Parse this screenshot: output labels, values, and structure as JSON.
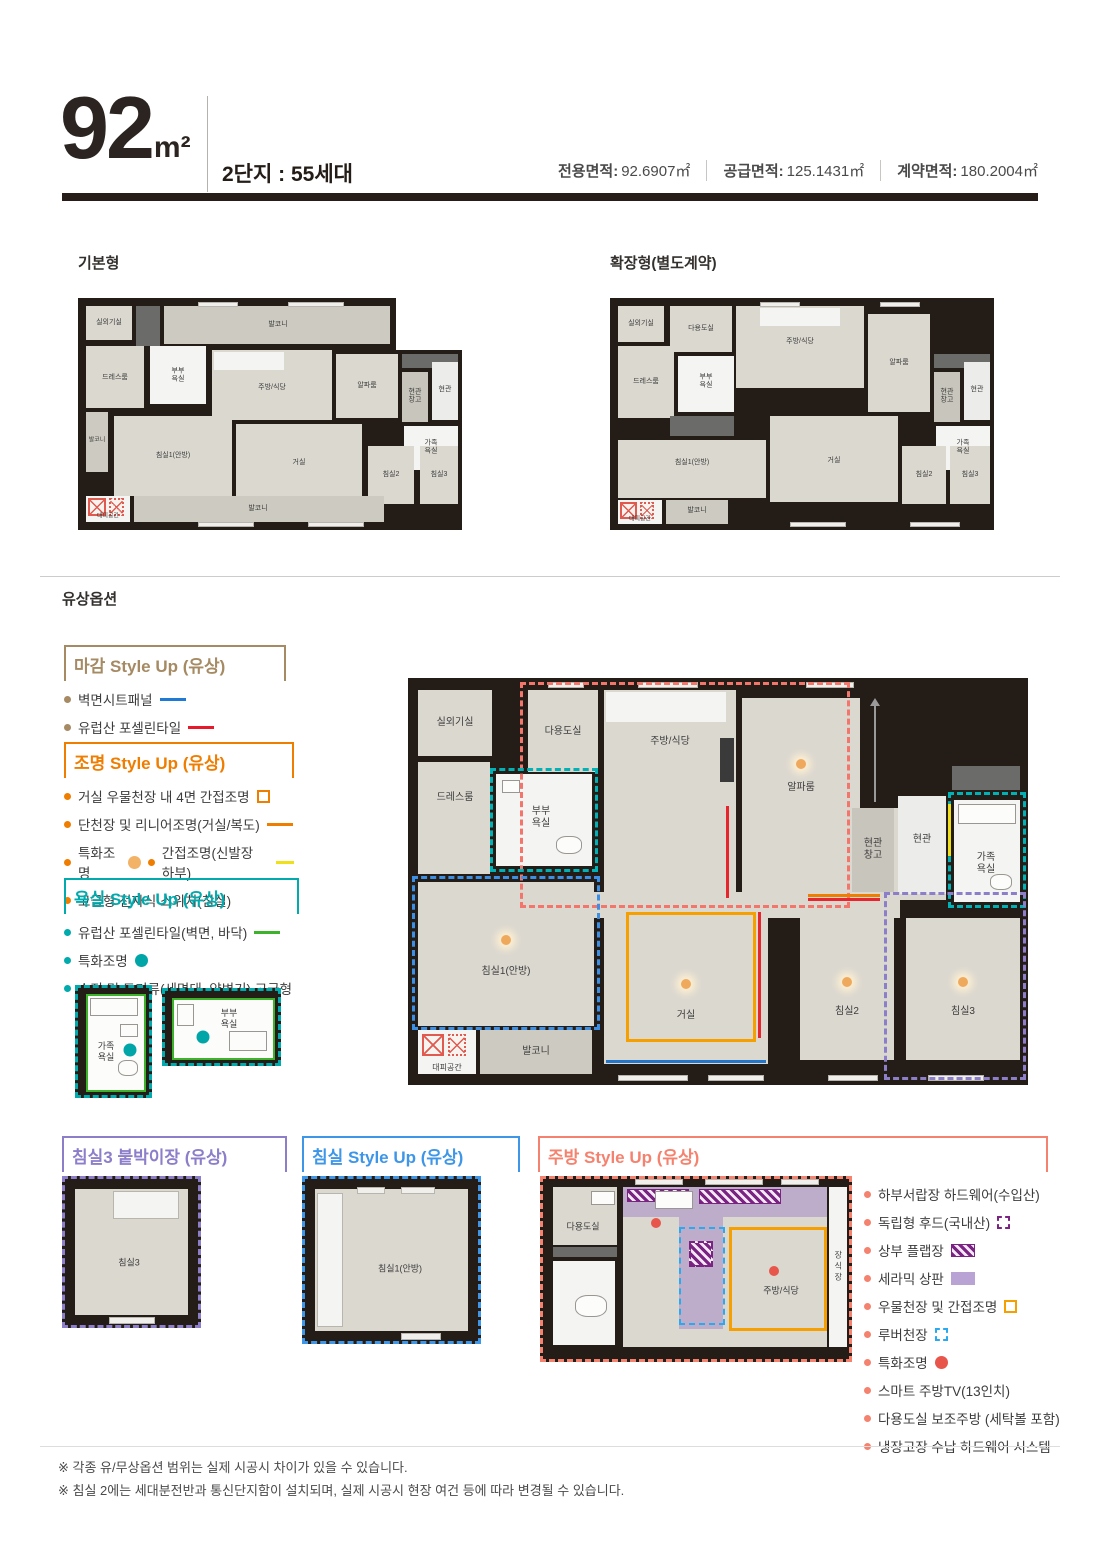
{
  "header": {
    "size": "92",
    "size_unit": "m²",
    "subtitle": "2단지 : 55세대",
    "metrics": [
      {
        "label": "전용면적:",
        "value": "92.6907㎡"
      },
      {
        "label": "공급면적:",
        "value": "125.1431㎡"
      },
      {
        "label": "계약면적:",
        "value": "180.2004㎡"
      }
    ]
  },
  "sections": {
    "basic": "기본형",
    "extended": "확장형(별도계약)",
    "paid": "유상옵션"
  },
  "rooms": {
    "outdoor": "실외기실",
    "utility": "다용도실",
    "dress": "드레스룸",
    "bath_couple": "부부 욕실",
    "kitchen": "주방/식당",
    "alpha": "알파룸",
    "storage": "현관 창고",
    "entrance": "현관",
    "bath_family": "가족 욕실",
    "balcony": "발코니",
    "bed1": "침실1(안방)",
    "living": "거실",
    "bed2": "침실2",
    "bed3": "침실3",
    "refuge": "대피공간",
    "closet": "장식장"
  },
  "legends": {
    "finish": {
      "title": "마감 Style Up (유상)",
      "items": [
        "벽면시트패널",
        "유럽산 포셀린타일"
      ]
    },
    "lighting": {
      "title": "조명 Style Up (유상)",
      "items": [
        "거실 우물천장 내 4면 간접조명",
        "단천장 및 리니어조명(거실/복도)",
        "특화조명",
        "간접조명(신발장 하부)",
        "고급형 전자식 스위치(침실)"
      ]
    },
    "bath": {
      "title": "욕실 Style Up (유상)",
      "items": [
        "유럽산 포셀린타일(벽면, 바닥)",
        "특화조명",
        "수전 및 도기류(세면대, 양변기) 고급형"
      ]
    },
    "bed3": {
      "title": "침실3 붙박이장 (유상)"
    },
    "bedroom": {
      "title": "침실 Style Up (유상)"
    },
    "kitchen": {
      "title": "주방 Style Up (유상)",
      "items": [
        "하부서랍장 하드웨어(수입산)",
        "독립형 후드(국내산)",
        "상부 플랩장",
        "세라믹 상판",
        "우물천장 및 간접조명",
        "루버천장",
        "특화조명",
        "스마트 주방TV(13인치)",
        "다용도실 보조주방 (세탁볼 포함)",
        "냉장고장 수납 하드웨어 시스템"
      ]
    }
  },
  "colors": {
    "finish": "#a58a63",
    "lighting": "#ef7d00",
    "bath": "#00aaad",
    "bed3_closet": "#8c7ec9",
    "bedroom": "#3d96e8",
    "kitchen": "#f5826e",
    "sheet_panel_line": "#1f7ad6",
    "porcelain_line": "#e8192b",
    "bath_tile_line": "#3cb32a",
    "indirect_line_yellow": "#f0e019"
  },
  "footnotes": [
    "※ 각종 유/무상옵션 범위는 실제 시공시 차이가 있을 수 있습니다.",
    "※ 침실 2에는 세대분전반과 통신단지함이 설치되며, 실제 시공시 현장 여건 등에 따라 변경될 수 있습니다."
  ]
}
